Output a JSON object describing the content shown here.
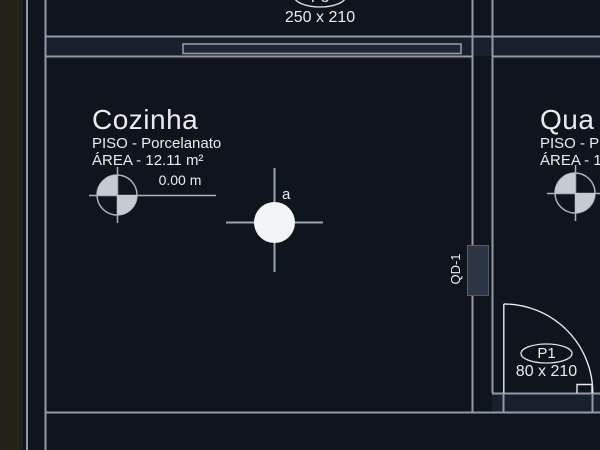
{
  "app": {
    "type": "cad-floor-plan-view"
  },
  "colors": {
    "background": "#10151d",
    "left_strip": "#242119",
    "wall_line": "#929aa8",
    "door_line": "#e6e9ed",
    "text": "#e9ecef",
    "marker_fill": "#c6cbd1",
    "light_fill": "#f3f4f6",
    "panel_fill": "#2c3644"
  },
  "rooms": {
    "cozinha": {
      "name": "Cozinha",
      "floor": "PISO - Porcelanato",
      "area": "ÁREA - 12.11 m²"
    },
    "quarto": {
      "name": "Qua",
      "floor": "PISO - P",
      "area": "ÁREA - 1"
    }
  },
  "doors": {
    "p3": {
      "label": "P3",
      "size": "250 x 210"
    },
    "p1": {
      "label": "P1",
      "size": "80 x 210"
    }
  },
  "annotations": {
    "level": {
      "value": "0.00 m"
    },
    "light": {
      "label": "a"
    },
    "electrical_panel": {
      "label": "QD-1"
    }
  }
}
